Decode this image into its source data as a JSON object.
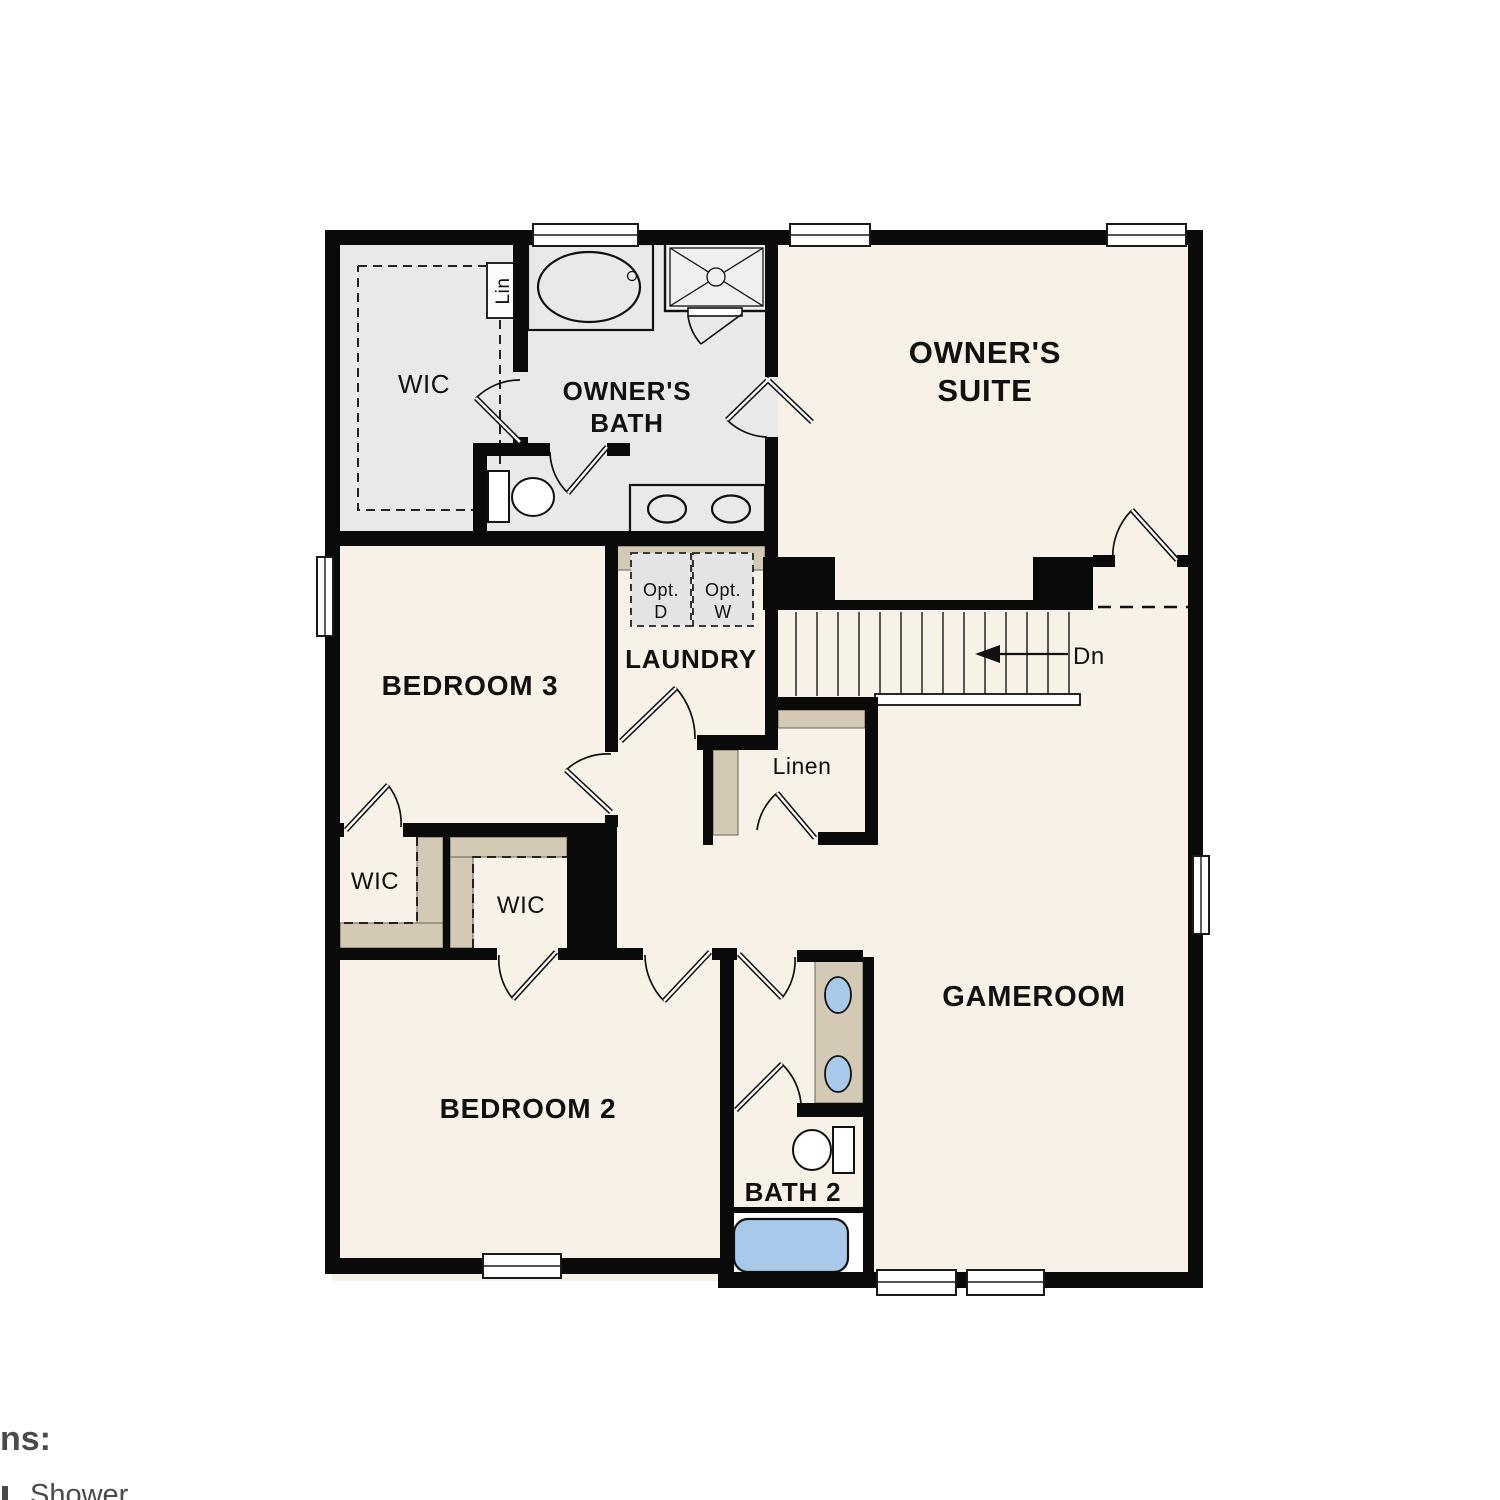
{
  "colors": {
    "wall": "#0a0a0a",
    "room_fill": "#f8f1e7",
    "wet_area_fill": "#e9e9e9",
    "shelf_fill": "#d3c9b4",
    "appliance_fill": "#e4e4e4",
    "fixture_blue": "#a8c9e9",
    "legend_text": "#4a4a4a"
  },
  "rooms": {
    "owners_suite": {
      "line1": "OWNER'S",
      "line2": "SUITE"
    },
    "owners_bath": {
      "line1": "OWNER'S",
      "line2": "BATH"
    },
    "owners_wic": {
      "label": "WIC"
    },
    "lin_cabinet": {
      "label": "Lin"
    },
    "laundry": {
      "label": "LAUNDRY"
    },
    "opt_dryer": {
      "line1": "Opt.",
      "line2": "D"
    },
    "opt_washer": {
      "line1": "Opt.",
      "line2": "W"
    },
    "stairs": {
      "label": "Dn"
    },
    "linen": {
      "label": "Linen"
    },
    "bedroom3": {
      "label": "BEDROOM 3"
    },
    "bedroom3_wic": {
      "label": "WIC"
    },
    "bedroom2_wic": {
      "label": "WIC"
    },
    "bedroom2": {
      "label": "BEDROOM 2"
    },
    "bath2": {
      "label": "BATH 2"
    },
    "gameroom": {
      "label": "GAMEROOM"
    }
  },
  "legend": {
    "heading": "ns:",
    "item": "Shower"
  }
}
